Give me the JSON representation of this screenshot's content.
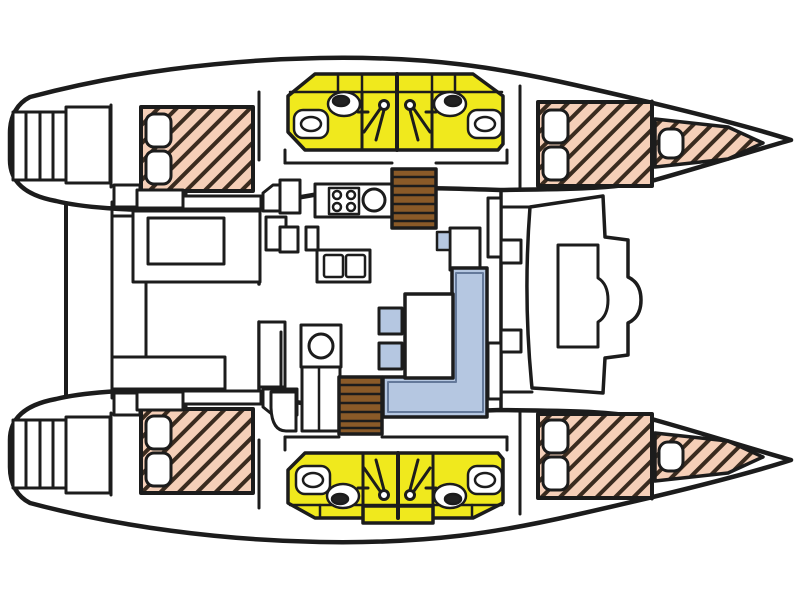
{
  "diagram": {
    "title": "Catamaran interior deck plan, top view, bow to the right",
    "type": "boat-floor-plan",
    "orientation": "bow-right",
    "legend": {
      "yellow": "heads (bathrooms) with shower, WC and sink",
      "hatched_pink": "berth mattresses with pillows",
      "light_blue": "upholstered seating",
      "brown": "companionway steps",
      "white": "deck, joinery and furniture"
    },
    "colors": {
      "background": "#ffffff",
      "outline": "#1c1c1c",
      "deck": "#ffffff",
      "bathroom": "#f0e91d",
      "mattress": "#f5cfb8",
      "mattress_hatch": "#3a2b1f",
      "steps": "#8a5a28",
      "upholstery": "#b5c7e1",
      "fixture_dark": "#222222",
      "sofa_inner_line": "#64799a"
    },
    "areas": {
      "port_hull": {
        "label": "Port hull (top)",
        "spaces": [
          "swim steps",
          "aft double cabin",
          "aft head with shower and WC",
          "forward head with shower and WC",
          "forward double cabin",
          "forepeak berth"
        ]
      },
      "starboard_hull": {
        "label": "Starboard hull (bottom)",
        "spaces": [
          "swim steps",
          "aft double cabin",
          "aft head with shower and WC",
          "forward head with shower and WC",
          "forward double cabin",
          "forepeak berth"
        ]
      },
      "bridgedeck": {
        "label": "Bridgedeck",
        "spaces": [
          "aft cockpit with table and benches",
          "salon galley with 4-burner stove and round sink",
          "chart table with seat",
          "L-shaped sofa with dining table and two stools",
          "wet-bar sink cabinet",
          "port companionway stairs",
          "starboard companionway stairs",
          "forward cockpit seat"
        ]
      }
    },
    "fixture_counts": {
      "double_berths": 4,
      "forepeak_berths": 2,
      "heads": 4,
      "toilets": 4,
      "showers": 4,
      "bathroom_sinks": 4,
      "galley_burners": 4,
      "tables": 3,
      "stools": 2,
      "companionway_stairs": 2
    }
  }
}
